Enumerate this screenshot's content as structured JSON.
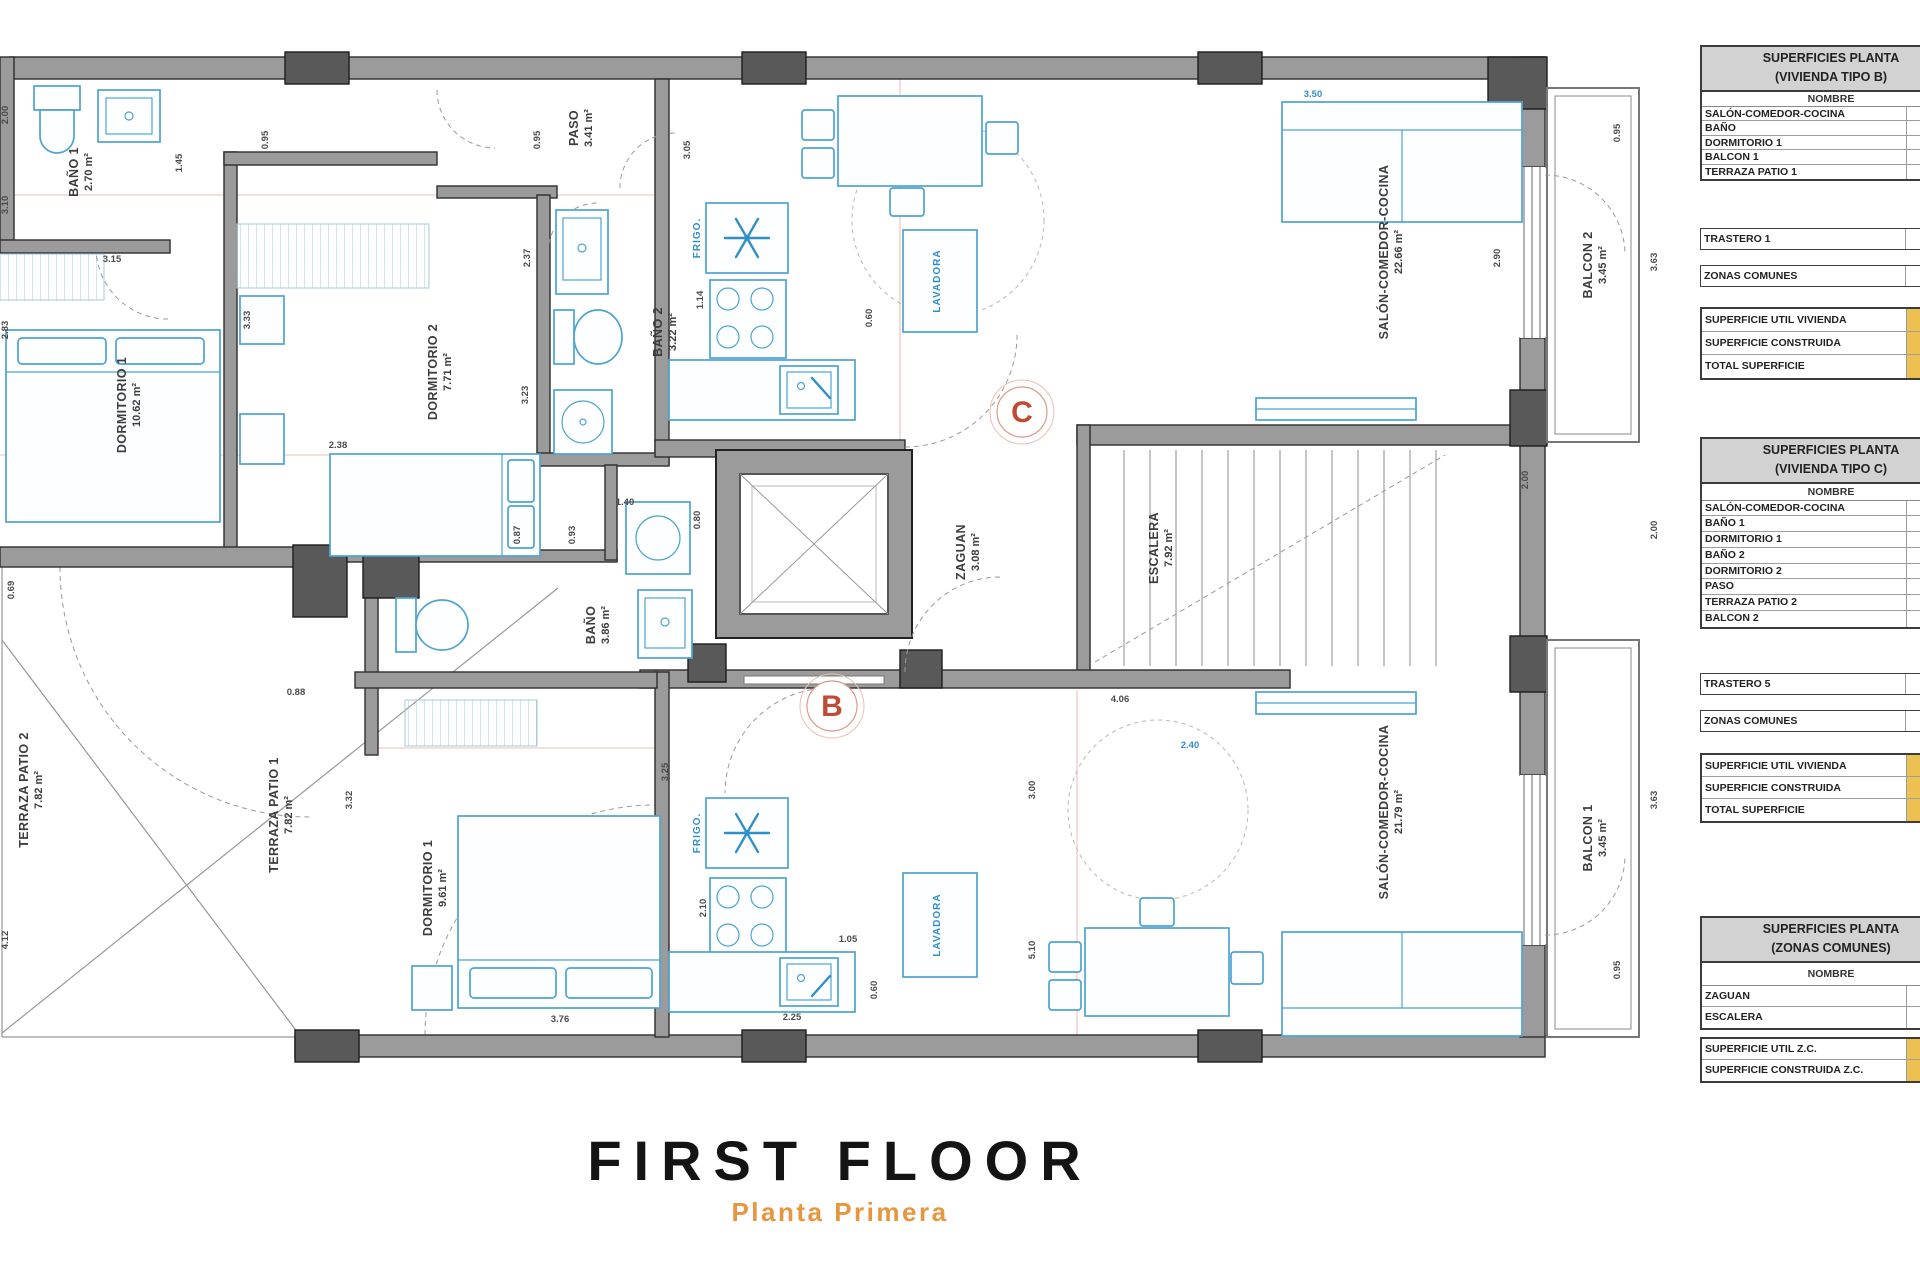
{
  "title": {
    "main": "FIRST FLOOR",
    "subtitle": "Planta Primera"
  },
  "colors": {
    "wall_gray": "#9b9b9b",
    "wall_dark": "#595959",
    "fixture_blue": "#4fa3d1",
    "appliance_blue": "#2f8fc9",
    "dimension_line_red": "#e2aaa2",
    "marker_red": "#bf4b33",
    "table_header_gray": "#d2d2d2",
    "totals_yellow": "#ecc152",
    "subtitle_orange": "#e8953f"
  },
  "floorplan": {
    "rooms": [
      {
        "name": "BAÑO 1",
        "area": "2.70 m²",
        "x": 78,
        "y": 172
      },
      {
        "name": "DORMITORIO 1",
        "area": "10.62 m²",
        "x": 126,
        "y": 405
      },
      {
        "name": "DORMITORIO 2",
        "area": "7.71 m²",
        "x": 437,
        "y": 372
      },
      {
        "name": "PASO",
        "area": "3.41 m²",
        "x": 578,
        "y": 128
      },
      {
        "name": "BAÑO 2",
        "area": "3.22 m²",
        "x": 662,
        "y": 332
      },
      {
        "name": "ZAGUAN",
        "area": "3.08 m²",
        "x": 965,
        "y": 552
      },
      {
        "name": "ESCALERA",
        "area": "7.92 m²",
        "x": 1158,
        "y": 548
      },
      {
        "name": "SALÓN-COMEDOR-COCINA",
        "area": "22.66 m²",
        "x": 1388,
        "y": 252
      },
      {
        "name": "BALCON 2",
        "area": "3.45 m²",
        "x": 1592,
        "y": 265
      },
      {
        "name": "SALÓN-COMEDOR-COCINA",
        "area": "21.79 m²",
        "x": 1388,
        "y": 812
      },
      {
        "name": "BALCON 1",
        "area": "3.45 m²",
        "x": 1592,
        "y": 838
      },
      {
        "name": "TERRAZA PATIO 2",
        "area": "7.82 m²",
        "x": 28,
        "y": 790
      },
      {
        "name": "TERRAZA PATIO 1",
        "area": "7.82 m²",
        "x": 278,
        "y": 815
      },
      {
        "name": "DORMITORIO 1",
        "area": "9.61 m²",
        "x": 432,
        "y": 888
      },
      {
        "name": "BAÑO",
        "area": "3.86 m²",
        "x": 595,
        "y": 625
      }
    ],
    "appliance_labels": [
      {
        "t": "LAVADORA",
        "x": 940,
        "y": 281
      },
      {
        "t": "LAVADORA",
        "x": 940,
        "y": 925
      },
      {
        "t": "FRIGO.",
        "x": 700,
        "y": 238
      },
      {
        "t": "FRIGO.",
        "x": 700,
        "y": 833
      }
    ],
    "markers": [
      {
        "letter": "C",
        "x": 1022,
        "y": 412
      },
      {
        "letter": "B",
        "x": 832,
        "y": 706
      }
    ],
    "dimensions": [
      {
        "v": "2.00",
        "x": 8,
        "y": 115,
        "r": -90
      },
      {
        "v": "3.10",
        "x": 8,
        "y": 205,
        "r": -90
      },
      {
        "v": "1.45",
        "x": 182,
        "y": 163,
        "r": -90
      },
      {
        "v": "0.95",
        "x": 268,
        "y": 140,
        "r": -90
      },
      {
        "v": "3.15",
        "x": 112,
        "y": 262,
        "r": 0
      },
      {
        "v": "2.83",
        "x": 8,
        "y": 330,
        "r": -90
      },
      {
        "v": "3.33",
        "x": 250,
        "y": 320,
        "r": -90
      },
      {
        "v": "2.38",
        "x": 338,
        "y": 448,
        "r": 0
      },
      {
        "v": "0.95",
        "x": 540,
        "y": 140,
        "r": -90
      },
      {
        "v": "2.37",
        "x": 530,
        "y": 258,
        "r": -90
      },
      {
        "v": "3.23",
        "x": 528,
        "y": 395,
        "r": -90
      },
      {
        "v": "1.40",
        "x": 625,
        "y": 505,
        "r": 0
      },
      {
        "v": "0.80",
        "x": 700,
        "y": 520,
        "r": -90
      },
      {
        "v": "1.14",
        "x": 703,
        "y": 300,
        "r": -90
      },
      {
        "v": "0.60",
        "x": 872,
        "y": 318,
        "r": -90
      },
      {
        "v": "3.05",
        "x": 690,
        "y": 150,
        "r": -90
      },
      {
        "v": "2.90",
        "x": 1500,
        "y": 258,
        "r": -90
      },
      {
        "v": "0.95",
        "x": 1620,
        "y": 133,
        "r": -90
      },
      {
        "v": "3.63",
        "x": 1657,
        "y": 262,
        "r": -90
      },
      {
        "v": "2.00",
        "x": 1657,
        "y": 530,
        "r": -90
      },
      {
        "v": "3.63",
        "x": 1657,
        "y": 800,
        "r": -90
      },
      {
        "v": "0.95",
        "x": 1620,
        "y": 970,
        "r": -90
      },
      {
        "v": "0.69",
        "x": 14,
        "y": 590,
        "r": -90
      },
      {
        "v": "0.88",
        "x": 296,
        "y": 695,
        "r": 0
      },
      {
        "v": "0.87",
        "x": 520,
        "y": 535,
        "r": -90
      },
      {
        "v": "0.93",
        "x": 575,
        "y": 535,
        "r": -90
      },
      {
        "v": "3.32",
        "x": 352,
        "y": 800,
        "r": -90
      },
      {
        "v": "4.12",
        "x": 8,
        "y": 940,
        "r": -90
      },
      {
        "v": "2.10",
        "x": 706,
        "y": 908,
        "r": -90
      },
      {
        "v": "3.25",
        "x": 668,
        "y": 772,
        "r": -90
      },
      {
        "v": "1.05",
        "x": 848,
        "y": 942,
        "r": 0
      },
      {
        "v": "0.60",
        "x": 877,
        "y": 990,
        "r": -90
      },
      {
        "v": "2.25",
        "x": 792,
        "y": 1020,
        "r": 0
      },
      {
        "v": "3.76",
        "x": 560,
        "y": 1022,
        "r": 0
      },
      {
        "v": "3.00",
        "x": 1035,
        "y": 790,
        "r": -90
      },
      {
        "v": "5.10",
        "x": 1035,
        "y": 950,
        "r": -90
      },
      {
        "v": "4.06",
        "x": 1120,
        "y": 702,
        "r": 0
      },
      {
        "v": "2.00",
        "x": 1528,
        "y": 480,
        "r": -90
      },
      {
        "v": "3.50",
        "x": 1313,
        "y": 97,
        "r": 0,
        "c": "blue"
      },
      {
        "v": "2.40",
        "x": 1190,
        "y": 748,
        "r": 0,
        "c": "blue"
      }
    ]
  },
  "tables": [
    {
      "title": [
        "SUPERFICIES PLANTA",
        "(VIVIENDA TIPO B)"
      ],
      "column_header": "NOMBRE",
      "top": 45,
      "nombre_h": 14,
      "row_h": 14.5,
      "rows": [
        "SALÓN-COMEDOR-COCINA",
        "BAÑO",
        "DORMITORIO 1",
        "BALCON 1",
        "TERRAZA PATIO 1"
      ],
      "boxes": [
        {
          "label": "TRASTERO 1",
          "top": 228
        },
        {
          "label": "ZONAS COMUNES",
          "top": 265
        }
      ],
      "totals": {
        "top": 307,
        "row_h": 23,
        "rows": [
          "SUPERFICIE UTIL VIVIENDA",
          "SUPERFICIE CONSTRUIDA",
          "TOTAL SUPERFICIE"
        ]
      }
    },
    {
      "title": [
        "SUPERFICIES PLANTA",
        "(VIVIENDA TIPO C)"
      ],
      "column_header": "NOMBRE",
      "top": 437,
      "nombre_h": 16,
      "row_h": 15.8,
      "rows": [
        "SALÓN-COMEDOR-COCINA",
        "BAÑO 1",
        "DORMITORIO 1",
        "BAÑO 2",
        "DORMITORIO 2",
        "PASO",
        "TERRAZA PATIO 2",
        "BALCON 2"
      ],
      "boxes": [
        {
          "label": "TRASTERO 5",
          "top": 673
        },
        {
          "label": "ZONAS COMUNES",
          "top": 710
        }
      ],
      "totals": {
        "top": 753,
        "row_h": 22,
        "rows": [
          "SUPERFICIE UTIL VIVIENDA",
          "SUPERFICIE CONSTRUIDA",
          "TOTAL SUPERFICIE"
        ]
      }
    },
    {
      "title": [
        "SUPERFICIES PLANTA",
        "(ZONAS COMUNES)"
      ],
      "column_header": "NOMBRE",
      "top": 916,
      "nombre_h": 22,
      "row_h": 21,
      "rows": [
        "ZAGUAN",
        "ESCALERA"
      ],
      "boxes": [],
      "totals": {
        "top": 1037,
        "row_h": 21,
        "rows": [
          "SUPERFICIE UTIL Z.C.",
          "SUPERFICIE CONSTRUIDA Z.C."
        ]
      }
    }
  ]
}
